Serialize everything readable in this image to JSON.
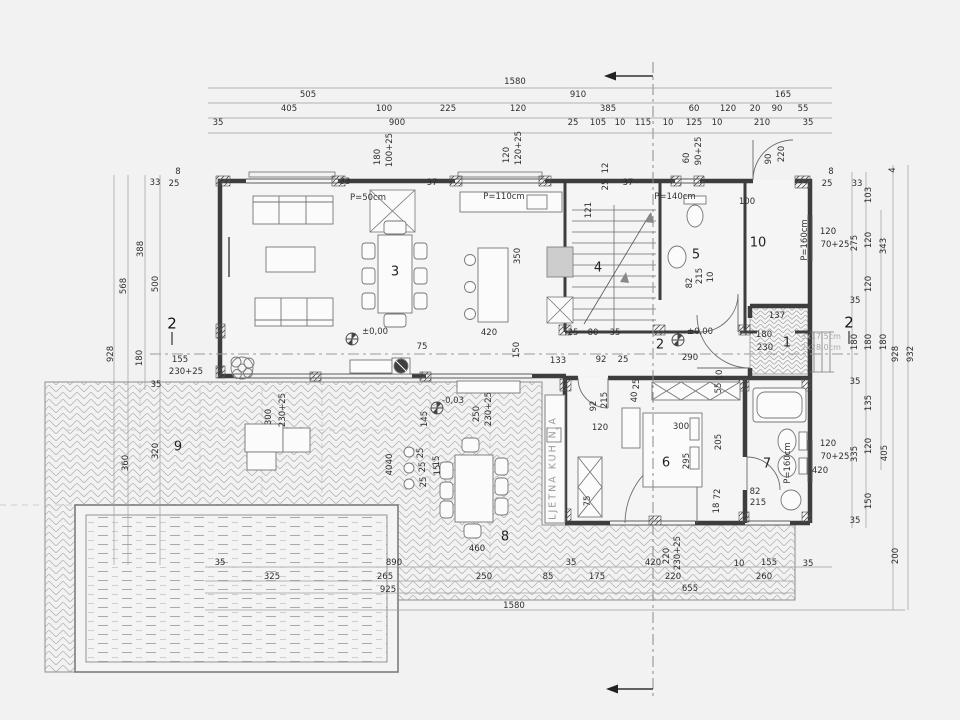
{
  "drawing": {
    "type": "architectural floor plan, ground floor with pool and terrace",
    "elevation_marks": [
      "±0,00",
      "±0,00",
      "-0,03"
    ],
    "room_numbers": [
      "1",
      "2",
      "3",
      "4",
      "5",
      "6",
      "7",
      "8",
      "9",
      "10"
    ],
    "section_marks": [
      "1",
      "2"
    ]
  },
  "labels": [
    {
      "t": "1580",
      "x": 515,
      "y": 82
    },
    {
      "t": "505",
      "x": 308,
      "y": 95
    },
    {
      "t": "910",
      "x": 578,
      "y": 95
    },
    {
      "t": "165",
      "x": 783,
      "y": 95
    },
    {
      "t": "405",
      "x": 289,
      "y": 109
    },
    {
      "t": "100",
      "x": 384,
      "y": 109
    },
    {
      "t": "225",
      "x": 448,
      "y": 109
    },
    {
      "t": "120",
      "x": 518,
      "y": 109
    },
    {
      "t": "385",
      "x": 608,
      "y": 109
    },
    {
      "t": "60",
      "x": 694,
      "y": 109
    },
    {
      "t": "120",
      "x": 728,
      "y": 109
    },
    {
      "t": "20",
      "x": 755,
      "y": 109
    },
    {
      "t": "90",
      "x": 777,
      "y": 109
    },
    {
      "t": "55",
      "x": 803,
      "y": 109
    },
    {
      "t": "35",
      "x": 218,
      "y": 123
    },
    {
      "t": "900",
      "x": 397,
      "y": 123
    },
    {
      "t": "25",
      "x": 573,
      "y": 123
    },
    {
      "t": "105",
      "x": 598,
      "y": 123
    },
    {
      "t": "10",
      "x": 620,
      "y": 123
    },
    {
      "t": "115",
      "x": 643,
      "y": 123
    },
    {
      "t": "10",
      "x": 668,
      "y": 123
    },
    {
      "t": "125",
      "x": 694,
      "y": 123
    },
    {
      "t": "10",
      "x": 717,
      "y": 123
    },
    {
      "t": "210",
      "x": 762,
      "y": 123
    },
    {
      "t": "35",
      "x": 808,
      "y": 123
    },
    {
      "t": "180",
      "x": 378,
      "y": 157,
      "r": 1
    },
    {
      "t": "100+25",
      "x": 390,
      "y": 150,
      "r": 1
    },
    {
      "t": "120",
      "x": 507,
      "y": 155,
      "r": 1
    },
    {
      "t": "120+25",
      "x": 519,
      "y": 148,
      "r": 1
    },
    {
      "t": "12",
      "x": 606,
      "y": 168,
      "r": 1
    },
    {
      "t": "25",
      "x": 606,
      "y": 185,
      "r": 1
    },
    {
      "t": "121",
      "x": 589,
      "y": 210,
      "r": 1
    },
    {
      "t": "60",
      "x": 687,
      "y": 158,
      "r": 1
    },
    {
      "t": "90+25",
      "x": 699,
      "y": 151,
      "r": 1
    },
    {
      "t": "90",
      "x": 769,
      "y": 159,
      "r": 1
    },
    {
      "t": "220",
      "x": 782,
      "y": 154,
      "r": 1
    },
    {
      "t": "33",
      "x": 345,
      "y": 182
    },
    {
      "t": "37",
      "x": 432,
      "y": 183
    },
    {
      "t": "37",
      "x": 628,
      "y": 183
    },
    {
      "t": "33",
      "x": 155,
      "y": 183
    },
    {
      "t": "25",
      "x": 174,
      "y": 184
    },
    {
      "t": "8",
      "x": 178,
      "y": 172
    },
    {
      "t": "25",
      "x": 827,
      "y": 184
    },
    {
      "t": "8",
      "x": 831,
      "y": 172
    },
    {
      "t": "33",
      "x": 857,
      "y": 184
    },
    {
      "t": "P=50cm",
      "x": 368,
      "y": 198,
      "k": "ann"
    },
    {
      "t": "P=110cm",
      "x": 504,
      "y": 197,
      "k": "ann"
    },
    {
      "t": "P=140cm",
      "x": 675,
      "y": 197,
      "k": "ann"
    },
    {
      "t": "100",
      "x": 747,
      "y": 202
    },
    {
      "t": "350",
      "x": 518,
      "y": 256,
      "r": 1
    },
    {
      "t": "420",
      "x": 489,
      "y": 333
    },
    {
      "t": "25",
      "x": 573,
      "y": 333
    },
    {
      "t": "80",
      "x": 593,
      "y": 333
    },
    {
      "t": "35",
      "x": 615,
      "y": 333
    },
    {
      "t": "150",
      "x": 517,
      "y": 350,
      "r": 1
    },
    {
      "t": "75",
      "x": 422,
      "y": 347
    },
    {
      "t": "82",
      "x": 690,
      "y": 283,
      "r": 1
    },
    {
      "t": "215",
      "x": 700,
      "y": 276,
      "r": 1
    },
    {
      "t": "10",
      "x": 711,
      "y": 277,
      "r": 1
    },
    {
      "t": "388",
      "x": 141,
      "y": 249,
      "r": 1
    },
    {
      "t": "500",
      "x": 156,
      "y": 284,
      "r": 1
    },
    {
      "t": "568",
      "x": 124,
      "y": 286,
      "r": 1
    },
    {
      "t": "928",
      "x": 111,
      "y": 354,
      "r": 1
    },
    {
      "t": "180",
      "x": 140,
      "y": 358,
      "r": 1
    },
    {
      "t": "155",
      "x": 180,
      "y": 360
    },
    {
      "t": "230+25",
      "x": 186,
      "y": 372
    },
    {
      "t": "35",
      "x": 156,
      "y": 385
    },
    {
      "t": "360",
      "x": 126,
      "y": 463,
      "r": 1
    },
    {
      "t": "320",
      "x": 156,
      "y": 451,
      "r": 1
    },
    {
      "t": "2",
      "x": 172,
      "y": 324,
      "k": "sec"
    },
    {
      "t": "2",
      "x": 849,
      "y": 323,
      "k": "sec"
    },
    {
      "t": "103",
      "x": 869,
      "y": 195,
      "r": 1
    },
    {
      "t": "275",
      "x": 855,
      "y": 243,
      "r": 1
    },
    {
      "t": "120",
      "x": 869,
      "y": 240,
      "r": 1
    },
    {
      "t": "343",
      "x": 884,
      "y": 246,
      "r": 1
    },
    {
      "t": "120",
      "x": 828,
      "y": 232
    },
    {
      "t": "70+25",
      "x": 835,
      "y": 245
    },
    {
      "t": "120",
      "x": 869,
      "y": 284,
      "r": 1
    },
    {
      "t": "35",
      "x": 855,
      "y": 301
    },
    {
      "t": "180",
      "x": 855,
      "y": 342,
      "r": 1
    },
    {
      "t": "180",
      "x": 869,
      "y": 342,
      "r": 1
    },
    {
      "t": "180",
      "x": 884,
      "y": 342,
      "r": 1
    },
    {
      "t": "928",
      "x": 896,
      "y": 354,
      "r": 1
    },
    {
      "t": "932",
      "x": 911,
      "y": 354,
      "r": 1
    },
    {
      "t": "4",
      "x": 893,
      "y": 170,
      "r": 1
    },
    {
      "t": "35",
      "x": 855,
      "y": 382
    },
    {
      "t": "135",
      "x": 869,
      "y": 403,
      "r": 1
    },
    {
      "t": "120",
      "x": 828,
      "y": 444
    },
    {
      "t": "70+25",
      "x": 835,
      "y": 457
    },
    {
      "t": "335",
      "x": 855,
      "y": 454,
      "r": 1
    },
    {
      "t": "120",
      "x": 869,
      "y": 446,
      "r": 1
    },
    {
      "t": "405",
      "x": 885,
      "y": 453,
      "r": 1
    },
    {
      "t": "420",
      "x": 820,
      "y": 471
    },
    {
      "t": "150",
      "x": 869,
      "y": 501,
      "r": 1
    },
    {
      "t": "35",
      "x": 855,
      "y": 521
    },
    {
      "t": "200",
      "x": 896,
      "y": 556,
      "r": 1
    },
    {
      "t": "P=160cm",
      "x": 805,
      "y": 240,
      "r": 1,
      "k": "ann"
    },
    {
      "t": "P=160cm",
      "x": 788,
      "y": 463,
      "r": 1,
      "k": "ann"
    },
    {
      "t": "±0,00",
      "x": 375,
      "y": 332,
      "k": "ann"
    },
    {
      "t": "±0,00",
      "x": 700,
      "y": 332,
      "k": "ann"
    },
    {
      "t": "-0,03",
      "x": 453,
      "y": 401,
      "k": "ann"
    },
    {
      "t": "133",
      "x": 558,
      "y": 361
    },
    {
      "t": "92",
      "x": 601,
      "y": 360
    },
    {
      "t": "25",
      "x": 623,
      "y": 360
    },
    {
      "t": "290",
      "x": 690,
      "y": 358
    },
    {
      "t": "137",
      "x": 777,
      "y": 316
    },
    {
      "t": "180",
      "x": 764,
      "y": 335
    },
    {
      "t": "230",
      "x": 765,
      "y": 348
    },
    {
      "t": "3x17,5cm",
      "x": 821,
      "y": 337,
      "k": "grey"
    },
    {
      "t": "2x28,0cm",
      "x": 821,
      "y": 348,
      "k": "grey"
    },
    {
      "t": "1",
      "x": 787,
      "y": 343,
      "k": "room"
    },
    {
      "t": "2",
      "x": 660,
      "y": 345,
      "k": "room"
    },
    {
      "t": "3",
      "x": 395,
      "y": 272,
      "k": "room"
    },
    {
      "t": "4",
      "x": 598,
      "y": 268,
      "k": "room"
    },
    {
      "t": "5",
      "x": 696,
      "y": 255,
      "k": "room"
    },
    {
      "t": "10",
      "x": 758,
      "y": 243,
      "k": "room"
    },
    {
      "t": "6",
      "x": 666,
      "y": 463,
      "k": "room"
    },
    {
      "t": "7",
      "x": 767,
      "y": 464,
      "k": "room"
    },
    {
      "t": "8",
      "x": 505,
      "y": 537,
      "k": "room"
    },
    {
      "t": "9",
      "x": 178,
      "y": 447,
      "k": "room"
    },
    {
      "t": "25",
      "x": 637,
      "y": 384,
      "r": 1
    },
    {
      "t": "40",
      "x": 635,
      "y": 397,
      "r": 1
    },
    {
      "t": "10",
      "x": 720,
      "y": 375,
      "r": 1
    },
    {
      "t": "55",
      "x": 719,
      "y": 388,
      "r": 1
    },
    {
      "t": "92",
      "x": 594,
      "y": 406,
      "r": 1
    },
    {
      "t": "215",
      "x": 605,
      "y": 400,
      "r": 1
    },
    {
      "t": "120",
      "x": 600,
      "y": 428
    },
    {
      "t": "300",
      "x": 681,
      "y": 427
    },
    {
      "t": "205",
      "x": 719,
      "y": 442,
      "r": 1
    },
    {
      "t": "295",
      "x": 687,
      "y": 461,
      "r": 1
    },
    {
      "t": "72",
      "x": 718,
      "y": 494,
      "r": 1
    },
    {
      "t": "18",
      "x": 717,
      "y": 508,
      "r": 1
    },
    {
      "t": "82",
      "x": 755,
      "y": 492
    },
    {
      "t": "215",
      "x": 758,
      "y": 503
    },
    {
      "t": "75",
      "x": 588,
      "y": 501,
      "r": 1
    },
    {
      "t": "300",
      "x": 269,
      "y": 417,
      "r": 1
    },
    {
      "t": "230+25",
      "x": 283,
      "y": 410,
      "r": 1
    },
    {
      "t": "145",
      "x": 425,
      "y": 419,
      "r": 1
    },
    {
      "t": "250",
      "x": 477,
      "y": 414,
      "r": 1
    },
    {
      "t": "230+25",
      "x": 489,
      "y": 409,
      "r": 1
    },
    {
      "t": "40",
      "x": 390,
      "y": 459,
      "r": 1
    },
    {
      "t": "40",
      "x": 390,
      "y": 470,
      "r": 1
    },
    {
      "t": "25",
      "x": 421,
      "y": 453,
      "r": 1
    },
    {
      "t": "25",
      "x": 423,
      "y": 467,
      "r": 1
    },
    {
      "t": "25",
      "x": 424,
      "y": 482,
      "r": 1
    },
    {
      "t": "15",
      "x": 437,
      "y": 461,
      "r": 1
    },
    {
      "t": "15",
      "x": 438,
      "y": 470,
      "r": 1
    },
    {
      "t": "LJETNA KUHINJA",
      "x": 553,
      "y": 468,
      "r": 1,
      "k": "lk"
    },
    {
      "t": "460",
      "x": 477,
      "y": 549
    },
    {
      "t": "35",
      "x": 220,
      "y": 563
    },
    {
      "t": "890",
      "x": 394,
      "y": 563
    },
    {
      "t": "35",
      "x": 571,
      "y": 563
    },
    {
      "t": "420",
      "x": 653,
      "y": 563
    },
    {
      "t": "220",
      "x": 667,
      "y": 556,
      "r": 1
    },
    {
      "t": "230+25",
      "x": 678,
      "y": 553,
      "r": 1
    },
    {
      "t": "10",
      "x": 739,
      "y": 564
    },
    {
      "t": "155",
      "x": 769,
      "y": 563
    },
    {
      "t": "35",
      "x": 808,
      "y": 564
    },
    {
      "t": "325",
      "x": 272,
      "y": 577
    },
    {
      "t": "265",
      "x": 385,
      "y": 577
    },
    {
      "t": "250",
      "x": 484,
      "y": 577
    },
    {
      "t": "85",
      "x": 548,
      "y": 577
    },
    {
      "t": "175",
      "x": 597,
      "y": 577
    },
    {
      "t": "220",
      "x": 673,
      "y": 577
    },
    {
      "t": "260",
      "x": 764,
      "y": 577
    },
    {
      "t": "925",
      "x": 388,
      "y": 590
    },
    {
      "t": "655",
      "x": 690,
      "y": 589
    },
    {
      "t": "1580",
      "x": 514,
      "y": 606
    }
  ]
}
